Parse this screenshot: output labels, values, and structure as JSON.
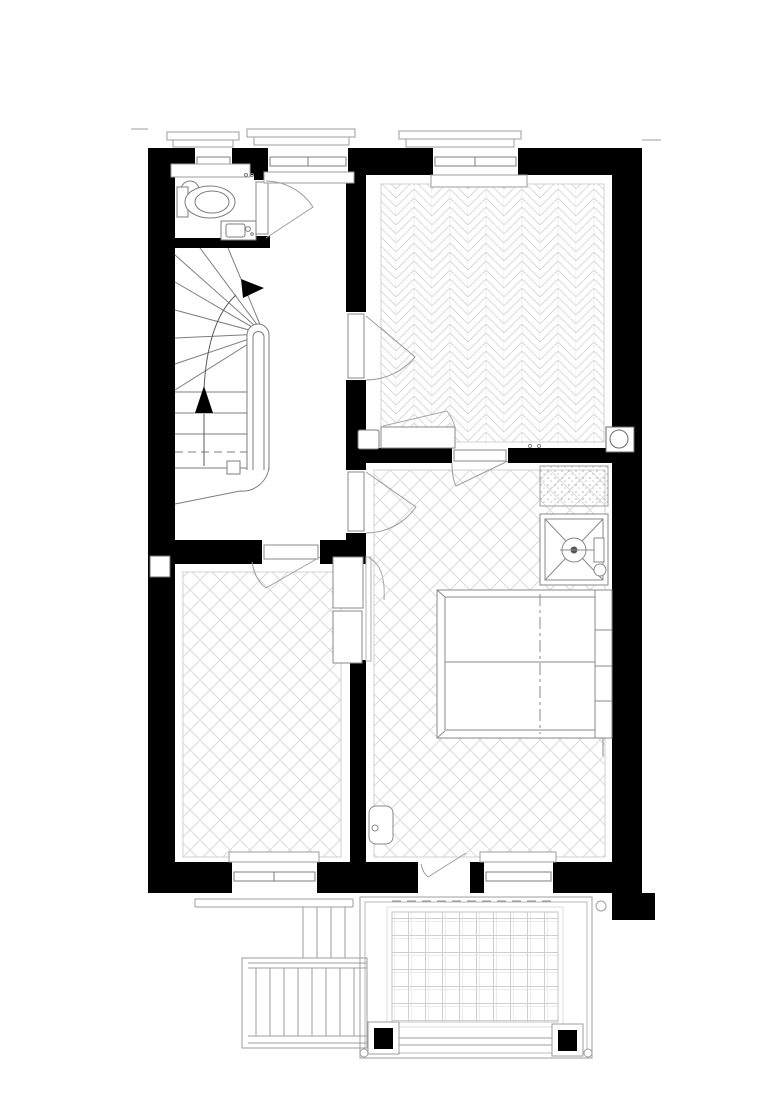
{
  "meta": {
    "drawing_type": "architectural-floor-plan",
    "canvas": {
      "width": 780,
      "height": 1103
    },
    "visible_text": []
  },
  "colors": {
    "wall": "#000000",
    "paper": "#ffffff",
    "fixture_line": "#7d7d7d",
    "light_line": "#9d9d9d",
    "faint_line": "#bdbdbd",
    "pattern_line": "#dadada",
    "tile_line": "#cfcfcf",
    "arrow": "#000000"
  },
  "icons": {
    "toilet": "toilet-plan-symbol",
    "sink": "hand-basin-symbol",
    "shower": "shower-tray-x-symbol",
    "bed": "double-bed-symbol",
    "stair_up_arrow": "filled-triangle-up",
    "stair_turn_arrow": "filled-triangle-right",
    "flue": "circle-in-box",
    "downspout": "small-circle"
  },
  "features": {
    "rooms": [
      "wc",
      "stair-hall",
      "room-top-right-herringbone",
      "room-bottom-left-lattice",
      "bedroom-lattice"
    ],
    "floor_patterns": [
      "herringbone-parquet",
      "diagonal-lattice",
      "terrace-tile-grid",
      "stipple-mat"
    ],
    "fixtures": [
      "toilet",
      "sink",
      "winder-staircase",
      "handrail",
      "radiator-cabinet",
      "wardrobe-cabinets",
      "shower-tray",
      "double-bed",
      "side-cabinet",
      "flue-duct"
    ],
    "exterior": [
      "terrace-with-railing",
      "railing-posts",
      "exterior-stairs",
      "window-sills",
      "downspout"
    ],
    "window_count": 5,
    "door_count": 6
  }
}
